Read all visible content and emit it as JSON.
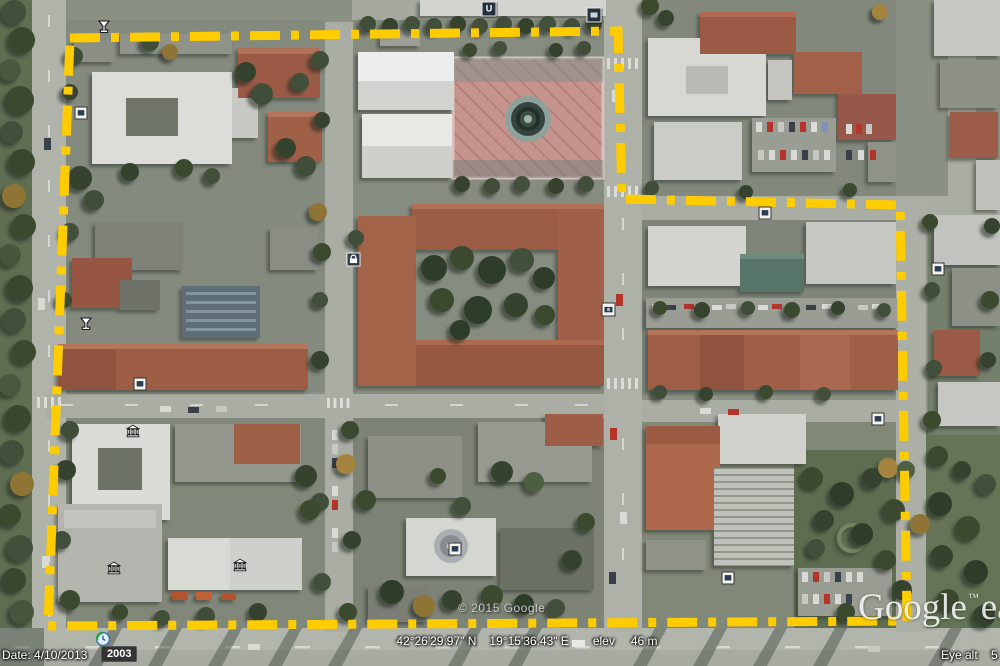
{
  "map": {
    "copyright": "© 2015 Google",
    "logo_brand": "Google",
    "logo_tm": "™",
    "logo_product": "earth",
    "boundary_color": "#ffcc00",
    "icons": [
      {
        "name": "bar-icon",
        "type": "martini",
        "x": 104,
        "y": 27
      },
      {
        "name": "placemark-icon",
        "type": "white-square",
        "x": 81,
        "y": 113
      },
      {
        "name": "university-icon",
        "type": "dark-square",
        "glyph": "U",
        "x": 489,
        "y": 9
      },
      {
        "name": "photo-icon",
        "type": "photo",
        "x": 594,
        "y": 15
      },
      {
        "name": "shopping-icon",
        "type": "bag",
        "x": 353,
        "y": 259
      },
      {
        "name": "camera-icon",
        "type": "camera",
        "x": 608,
        "y": 309
      },
      {
        "name": "placemark-icon",
        "type": "white-square",
        "x": 765,
        "y": 213
      },
      {
        "name": "bar-icon",
        "type": "martini",
        "x": 86,
        "y": 324
      },
      {
        "name": "placemark-icon",
        "type": "white-square",
        "x": 140,
        "y": 384
      },
      {
        "name": "museum-icon",
        "type": "museum",
        "x": 133,
        "y": 431
      },
      {
        "name": "museum-icon",
        "type": "museum",
        "x": 114,
        "y": 568
      },
      {
        "name": "museum-icon",
        "type": "museum",
        "x": 240,
        "y": 565
      },
      {
        "name": "placemark-icon",
        "type": "white-square",
        "x": 455,
        "y": 549
      },
      {
        "name": "placemark-icon",
        "type": "white-square",
        "x": 728,
        "y": 578
      },
      {
        "name": "placemark-icon",
        "type": "white-square",
        "x": 878,
        "y": 419
      },
      {
        "name": "placemark-icon",
        "type": "white-square",
        "x": 938,
        "y": 269
      }
    ]
  },
  "status_bar": {
    "date": "Date: 4/10/2013",
    "imagery_year": "2003",
    "coordinates_lat": "42°26'29.97\" N",
    "coordinates_lon": "19°15'36.43\" E",
    "elev_label": "elev",
    "elev_value": "46 m",
    "eye_alt_label": "Eye alt",
    "eye_alt_value": "5"
  }
}
